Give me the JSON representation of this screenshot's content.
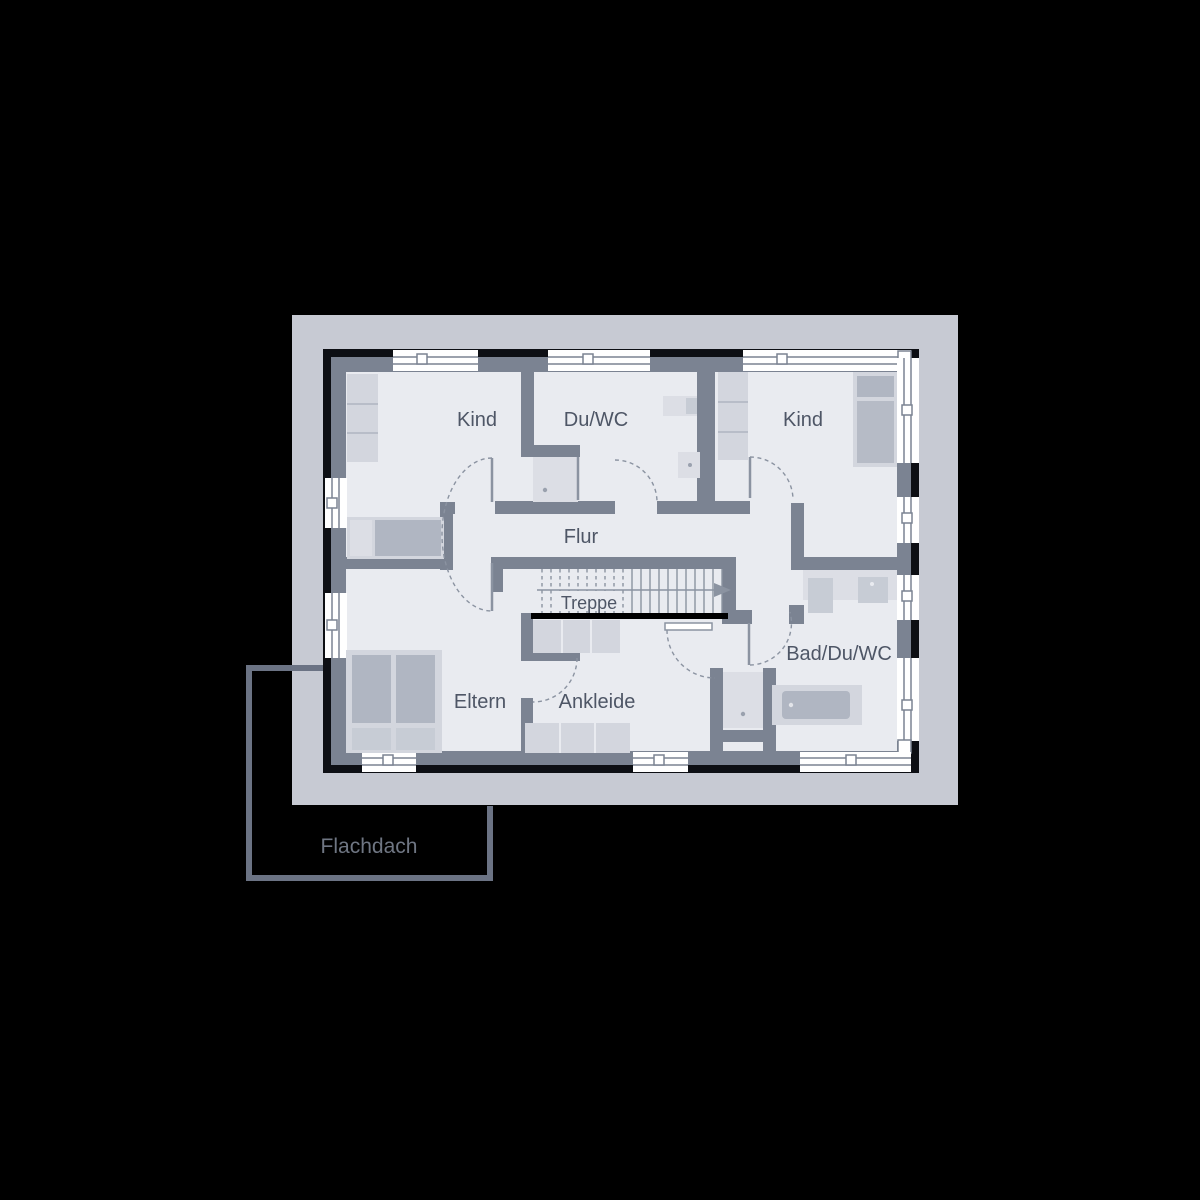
{
  "drawing": {
    "type": "architectural-floor-plan",
    "rooms": [
      {
        "id": "kind-left",
        "label": "Kind"
      },
      {
        "id": "du-wc",
        "label": "Du/WC"
      },
      {
        "id": "kind-right",
        "label": "Kind"
      },
      {
        "id": "flur",
        "label": "Flur"
      },
      {
        "id": "treppe",
        "label": "Treppe"
      },
      {
        "id": "eltern",
        "label": "Eltern"
      },
      {
        "id": "ankleide",
        "label": "Ankleide"
      },
      {
        "id": "bad-du-wc",
        "label": "Bad/Du/WC"
      }
    ],
    "roof_label": "Flachdach",
    "colors": {
      "background": "#000000",
      "roof_overhang": "#c7cad3",
      "floor": "#e9ebf0",
      "walls": "#7b8392",
      "outer_outline": "#0d0f14",
      "furniture_light": "#d3d6de",
      "furniture_dark": "#b0b6c2",
      "thin_lines": "#8b93a1",
      "label_text": "#4e5666",
      "flachdach_outline": "#6b7384",
      "flachdach_text": "#6f7683",
      "window_white": "#ffffff",
      "stair_cut_line": "#000000"
    }
  }
}
